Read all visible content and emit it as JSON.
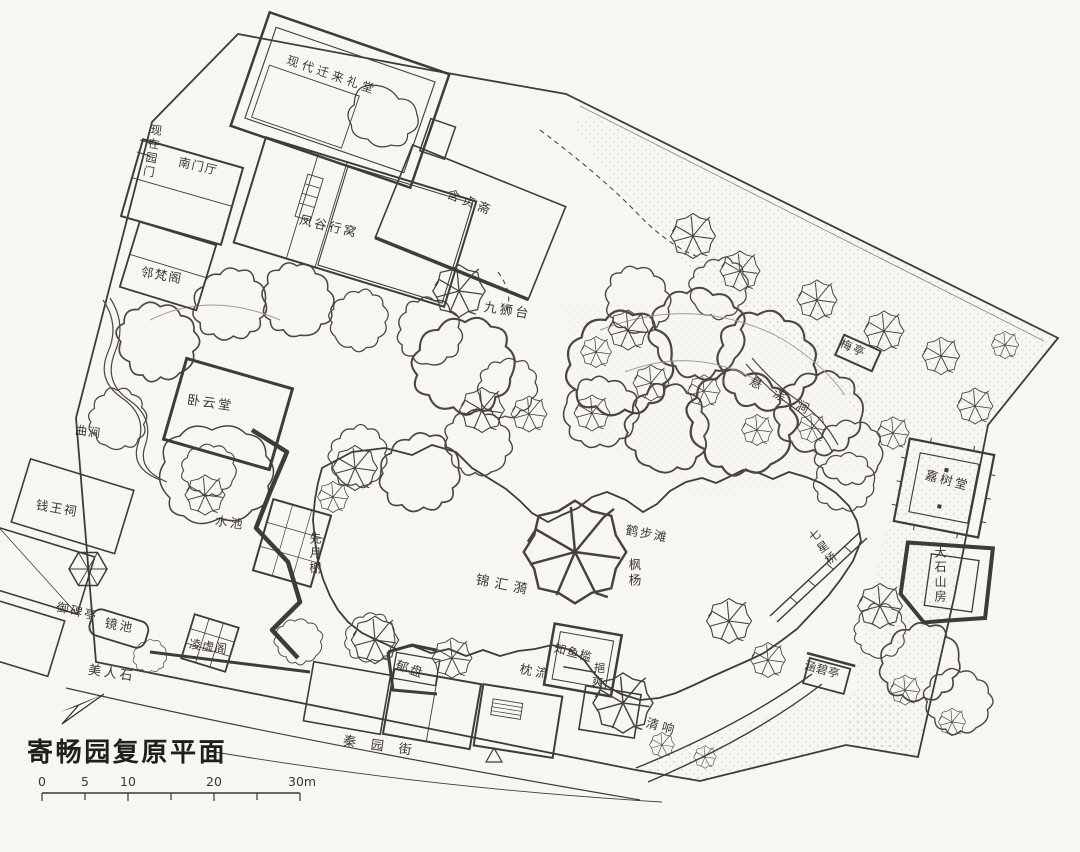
{
  "document": {
    "type": "scanned hand-drawn garden restoration plan",
    "title": "寄畅园复原平面",
    "paper_color": "#f7f6f2",
    "ink_color": "#3e3c36"
  },
  "scale_bar": {
    "labels": [
      "0",
      "5",
      "10",
      "20",
      "30m"
    ]
  },
  "icons": {
    "north_arrow": "north-arrow"
  },
  "labels": {
    "litang": "现代迁来礼堂",
    "xianzai_yuanmen": "现在园门",
    "nanmenting": "南门厅",
    "fenggu_xingwo": "凤谷行窝",
    "linfange": "邻梵阁",
    "hanzhenzhai": "含贞斋",
    "jiushitai": "九狮台",
    "woyuntang": "卧云堂",
    "qujian": "曲涧",
    "qianwangci": "钱王祠",
    "shuichi": "水池",
    "xianyuexie": "先月榭",
    "yubeiting": "御碑亭",
    "jingchi": "镜池",
    "lingxuge": "凌虚阁",
    "meirenshi": "美人石",
    "jinhuiyi": "锦汇漪",
    "hebutan": "鹤步滩",
    "fengyang": "枫杨",
    "xuancongjian": "悬淙涧",
    "meiting": "梅亭",
    "jiashutang": "嘉树堂",
    "dashishanfang": "大石山房",
    "qixingqiao": "七星桥",
    "yupan": "郁盘",
    "zhenliu": "枕流",
    "zhiyujian": "知鱼槛",
    "yishuang": "挹爽",
    "qingxiang": "清响",
    "hanbiting": "涵碧亭",
    "qinyuanjie": "秦园街"
  }
}
